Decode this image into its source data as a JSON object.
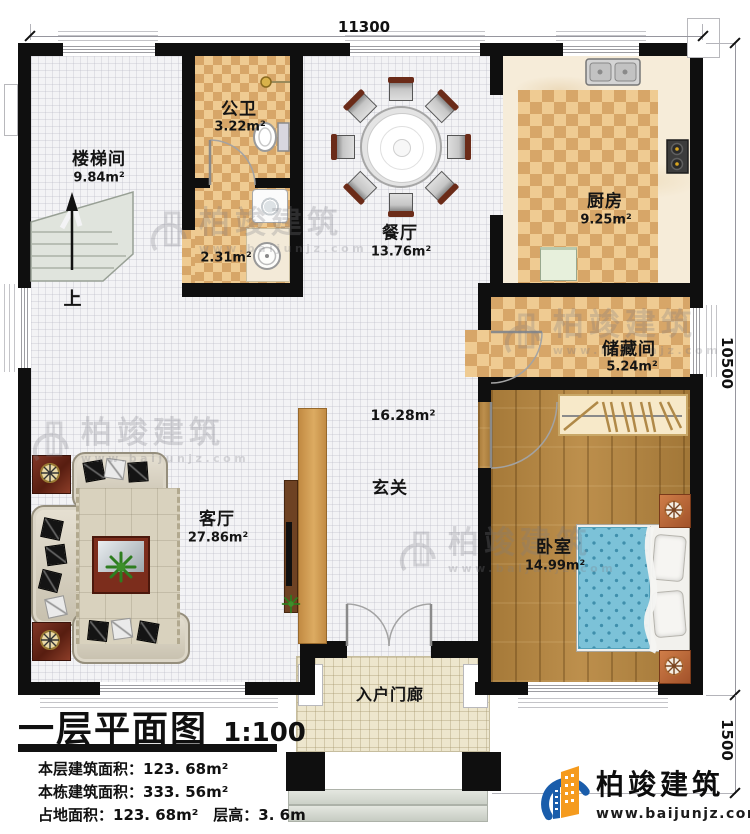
{
  "plan": {
    "title": "一层平面图",
    "scale": "1:100",
    "stats": [
      "本层建筑面积：123. 68m²",
      "本栋建筑面积：333. 56m²",
      "占地面积：123. 68m²　层高：3. 6m"
    ],
    "dimensions": {
      "top": "11300",
      "right": "10500",
      "porch": "1500"
    },
    "up_label": "上"
  },
  "rooms": {
    "stairwell": {
      "name": "楼梯间",
      "area": "9.84m²"
    },
    "bathroom": {
      "name": "公卫",
      "area": "3.22m²"
    },
    "laundry": {
      "area": "2.31m²"
    },
    "dining": {
      "name": "餐厅",
      "area": "13.76m²"
    },
    "kitchen": {
      "name": "厨房",
      "area": "9.25m²"
    },
    "storage": {
      "name": "储藏间",
      "area": "5.24m²"
    },
    "bedroom": {
      "name": "卧室",
      "area": "14.99m²"
    },
    "living": {
      "name": "客厅",
      "area": "27.86m²"
    },
    "foyer": {
      "name": "玄关",
      "area": "16.28m²"
    },
    "porch": {
      "name": "入户门廊"
    }
  },
  "branding": {
    "company": "柏竣建筑",
    "website": "www.baijunjz.com"
  },
  "colors": {
    "wall": "#0f0f0f",
    "checker_light": "#efcb92",
    "checker_dark": "#d7a668",
    "wood": "#b8873f",
    "bed_blue": "#7cc2d8",
    "tv_panel": "#cf9a55",
    "logo_blue": "#1a5dab",
    "logo_orange": "#f59b1e"
  }
}
